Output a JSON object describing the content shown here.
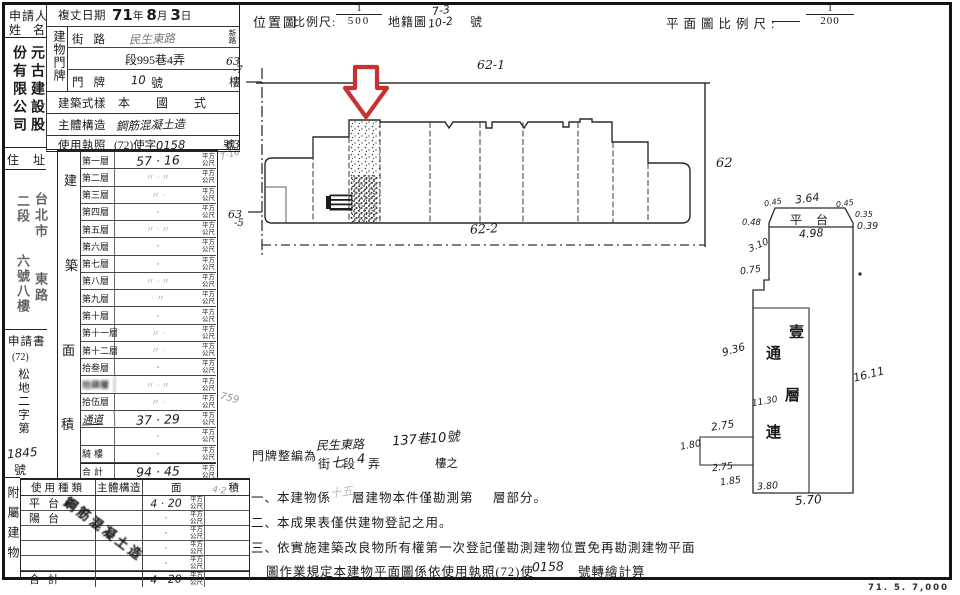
{
  "colors": {
    "arrow_red": "#c93030",
    "ink": "#1b1b1b"
  },
  "header": {
    "location_map": "位置圖",
    "scale_label": "比例尺:",
    "scale_num": "1",
    "scale_den": "500",
    "cadastre": "地籍圖",
    "cadastre_top": "7-3",
    "cadastre_bottom": "10-2",
    "cadastre_unit": "號",
    "plan_scale_label": "平面圖比例尺:",
    "plan_num": "1",
    "plan_den": "200"
  },
  "applicant": {
    "label_l1": "申請人",
    "label_l2": "姓名",
    "name_right": "元古建設股",
    "name_left": "份有限公司"
  },
  "form": {
    "date_label": "複丈日期",
    "date_year": "71",
    "yr": "年",
    "date_month": "8",
    "mo": "月",
    "date_day": "3",
    "dy": "日",
    "address_block_label": "建物門牌",
    "street_label": "街路",
    "street_value": "民生東路",
    "street_side": "新路",
    "lane_value": "段995巷4弄",
    "door_label": "門牌",
    "door_no": "10",
    "door_unit": "號",
    "door_suffix": "樓",
    "style_label": "建築式樣",
    "style_value": "本國式",
    "structure_label": "主體構造",
    "structure_value": "鋼筋混凝土造",
    "license_label": "使用執照",
    "license_prefix": "(72)使字",
    "license_no": "0158",
    "license_suffix": "號"
  },
  "residence": {
    "label": "住址",
    "col_right": "台北市　　東路",
    "col_left": "二段　　六號八樓"
  },
  "floors": {
    "area_label": "建築面積",
    "unit": "平方公尺",
    "margin_note": "759",
    "rows": [
      {
        "label": "第一層",
        "value": "57 · 16"
      },
      {
        "label": "第二層",
        "value": "〃 · 〃"
      },
      {
        "label": "第三層",
        "value": "〃 ·"
      },
      {
        "label": "第四層",
        "value": "·"
      },
      {
        "label": "第五層",
        "value": "〃 · 〃"
      },
      {
        "label": "第六層",
        "value": "·"
      },
      {
        "label": "第七層",
        "value": "·"
      },
      {
        "label": "第八層",
        "value": "〃 · 〃"
      },
      {
        "label": "第九層",
        "value": "· 〃"
      },
      {
        "label": "第十層",
        "value": "·"
      },
      {
        "label": "第十一層",
        "value": "〃 ·"
      },
      {
        "label": "第十二層",
        "value": "〃 ·"
      },
      {
        "label": "拾叁層",
        "value": "·"
      },
      {
        "label": "拾肆層",
        "value": "〃 · 〃"
      },
      {
        "label": "拾伍層",
        "value": "〃 ·"
      },
      {
        "label": "通道",
        "value": "37 · 29"
      },
      {
        "label": "",
        "value": "·"
      },
      {
        "label": "騎樓",
        "value": "·"
      },
      {
        "label": "合計",
        "value": "94 · 45"
      }
    ]
  },
  "application_doc": {
    "label": "申請書",
    "paren": "(72)",
    "col": "松地二字第",
    "number": "1845",
    "suffix": "號"
  },
  "annex": {
    "side_label": "附屬建物",
    "h_type": "使用種類",
    "h_structure": "主體構造",
    "h_area_1": "面",
    "h_area_2": "積",
    "stamp": "鋼筋混凝土造",
    "unit": "平方公尺",
    "margin_note": "4·2",
    "rows": [
      {
        "type": "平台",
        "area": "4 · 20"
      },
      {
        "type": "陽台",
        "area": "·"
      },
      {
        "type": "",
        "area": "·"
      },
      {
        "type": "",
        "area": "·"
      },
      {
        "type": "",
        "area": "·"
      },
      {
        "type": "合計",
        "area": "4 · 20"
      }
    ]
  },
  "site_plan": {
    "parcel_top": "62-1",
    "parcel_right": "62",
    "parcel_bottom": "62-2",
    "left_top_a": "63",
    "left_top_b": "-7",
    "left_mid": "63",
    "left_mid_note": "7·16",
    "left_bot_a": "63",
    "left_bot_b": "-5"
  },
  "floor_plan": {
    "platform": "平台",
    "d_045_l": "0.45",
    "d_364": "3.64",
    "d_045_r": "0.45",
    "d_048": "0.48",
    "d_035": "0.35",
    "d_039": "0.39",
    "d_498": "4.98",
    "d_310": "3.10",
    "d_075": "0.75",
    "d_936": "9.36",
    "d_1130": "11.30",
    "d_275_t": "2.75",
    "d_180": "1.80",
    "d_275_b": "2.75",
    "d_185": "1.85",
    "d_380": "3.80",
    "d_570": "5.70",
    "d_1611": "16.11",
    "c1": "壹",
    "c2": "通",
    "c3": "層",
    "c4": "連"
  },
  "house_number": {
    "label": "門牌整編為",
    "line1_a": "民生東路",
    "line1_b": "137巷10號",
    "line2_a": "街",
    "line2_b": "七",
    "line2_c": "段",
    "line2_d": "4",
    "line2_e": "弄",
    "line2_f": "樓之"
  },
  "notes": {
    "n1_no": "一、",
    "n1_a": "本建物係",
    "n1_hand": "十五",
    "n1_b": "層建物本件僅勘測第",
    "n1_c": "層部分。",
    "n2_no": "二、",
    "n2": "本成果表僅供建物登記之用。",
    "n3_no": "三、",
    "n3": "依實施建築改良物所有權第一次登記僅勘測建物位置免再勘測建物平面",
    "n3b_a": "圖作業規定本建物平面圖係依使用執照(72)使",
    "n3b_hand": "0158",
    "n3b_b": "號轉繪計算"
  },
  "footer": {
    "print_code": "71. 5. 7,000"
  }
}
